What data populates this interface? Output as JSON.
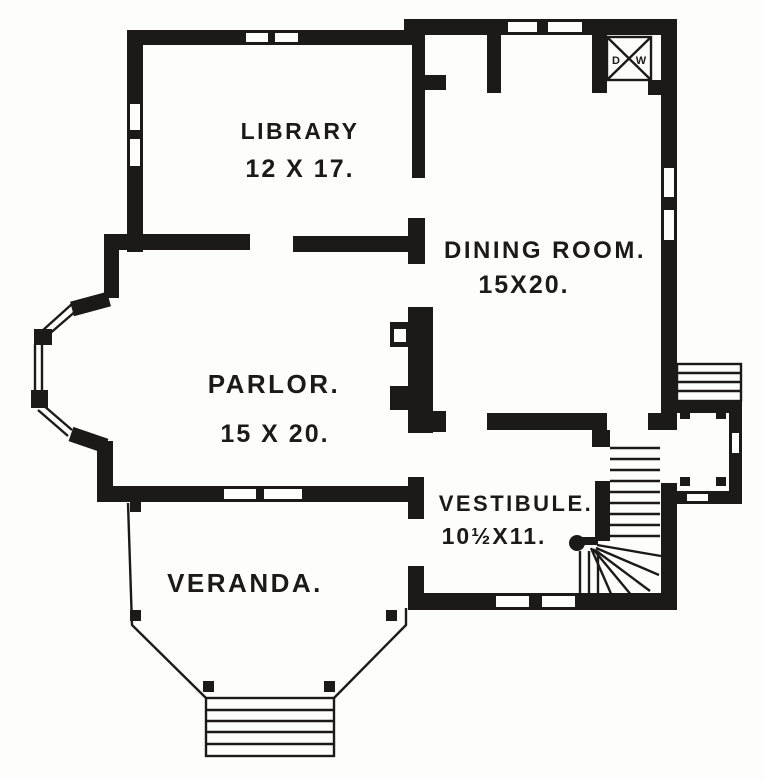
{
  "colors": {
    "ink": "#1b1a18",
    "paper": "#fdfdfc"
  },
  "rooms": {
    "library": {
      "name": "LIBRARY",
      "dims": "12 X 17."
    },
    "dining": {
      "name": "DINING ROOM.",
      "dims": "15X20."
    },
    "parlor": {
      "name": "PARLOR.",
      "dims": "15 X 20."
    },
    "vestibule": {
      "name": "VESTIBULE.",
      "dims": "10½X11."
    },
    "veranda": {
      "name": "VERANDA."
    }
  },
  "dumbwaiter": {
    "d": "D",
    "w": "W"
  }
}
